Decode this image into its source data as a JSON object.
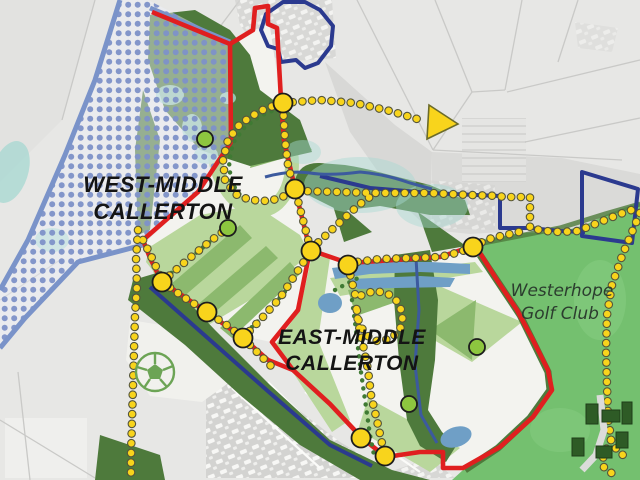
{
  "map": {
    "labels": {
      "west_site": {
        "line1": "WEST-MIDDLE",
        "line2": "CALLERTON",
        "color": "#141414"
      },
      "east_site": {
        "line1": "EAST-MIDDLE",
        "line2": "CALLERTON",
        "color": "#141414"
      },
      "golf_club": {
        "line1": "Westerhope",
        "line2": "Golf Club",
        "color": "#2c3d2f"
      }
    },
    "colors": {
      "site_boundary_red": "#e01f1f",
      "navy_boundary": "#2b3a8f",
      "flood_border_blue": "#7a93c9",
      "flood_dot_blue": "#7e91c8",
      "route_yellow": "#f8d41c",
      "route_dot_outline": "#55553a",
      "green_route_dot": "#3f7a33",
      "node_yellow": "#f8d41c",
      "node_green": "#8dc63f",
      "woodland_dark_green": "#4e7a3c",
      "open_space_light_green": "#b9d79c",
      "open_space_mid_green": "#8cb96e",
      "golf_green": "#74c06f",
      "pond_teal": "#a9d9d3",
      "pond_blue": "#6f9fc6",
      "aerial_gray": "#e7e7e5",
      "stream_blue": "#3c5a9e"
    },
    "icons": [
      {
        "name": "football-pitch-icon"
      },
      {
        "name": "direction-arrow-icon"
      },
      {
        "name": "golf-clubhouse-buildings"
      }
    ],
    "junction_nodes_yellow": [
      [
        283,
        103
      ],
      [
        295,
        189
      ],
      [
        311,
        251
      ],
      [
        348,
        265
      ],
      [
        473,
        247
      ],
      [
        162,
        282
      ],
      [
        207,
        312
      ],
      [
        243,
        338
      ],
      [
        361,
        438
      ],
      [
        385,
        456
      ]
    ],
    "access_nodes_green": [
      [
        205,
        139
      ],
      [
        228,
        228
      ],
      [
        477,
        347
      ],
      [
        409,
        404
      ]
    ]
  }
}
